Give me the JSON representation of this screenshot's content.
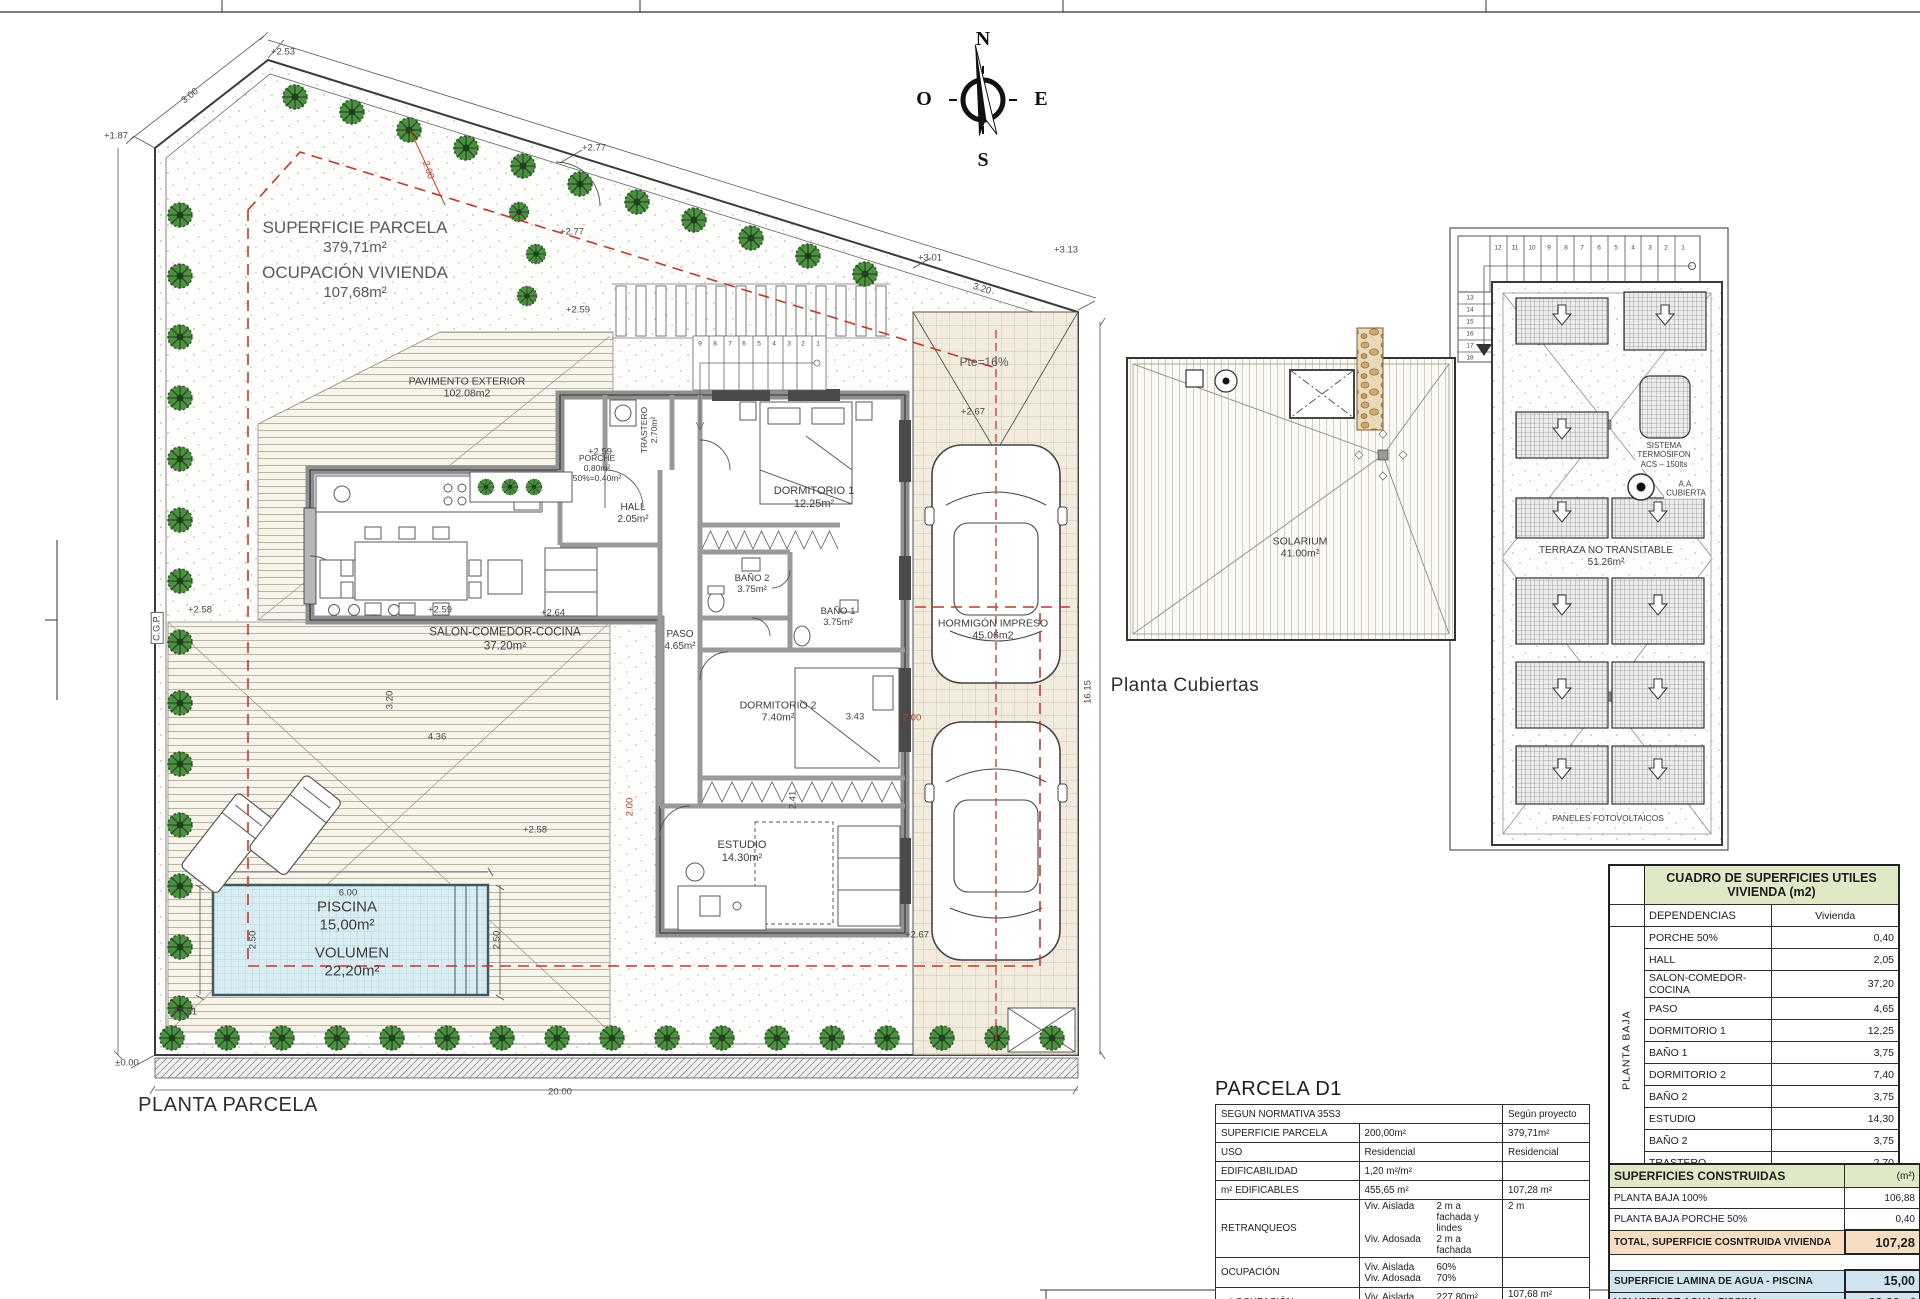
{
  "colors": {
    "accent_red": "#c0392b",
    "table_header_green": "#dfe9c5",
    "table_total_peach": "#f7ddc2",
    "table_water_blue": "#cfe4ee",
    "tree_green": "#4e8f43",
    "wall_gray": "#8f8f8f"
  },
  "icons": {
    "tree-icon": "garden tree (spiky green circle)",
    "car-icon": "top-view car",
    "lounger-icon": "sun lounger",
    "compass-rose-icon": "north arrow compass",
    "solar-panel-icon": "hatched photovoltaic panel",
    "down-arrow-icon": "white slope arrow",
    "aa-unit-icon": "air conditioning roof unit",
    "stair-icon": "stair run with numbered treads"
  },
  "plan_labels": [
    {
      "n": "parcel-surface-label",
      "lines": [
        "SUPERFICIE PARCELA"
      ],
      "x": 355,
      "y": 228,
      "s": 17,
      "cls": "g"
    },
    {
      "n": "parcel-surface-value",
      "lines": [
        "379,71m²"
      ],
      "x": 355,
      "y": 248,
      "s": 15,
      "cls": "g"
    },
    {
      "n": "parcel-occupation-label",
      "lines": [
        "OCUPACIÓN VIVIENDA"
      ],
      "x": 355,
      "y": 273,
      "s": 17,
      "cls": "g"
    },
    {
      "n": "parcel-occupation-value",
      "lines": [
        "107,68m²"
      ],
      "x": 355,
      "y": 293,
      "s": 15,
      "cls": "g"
    },
    {
      "n": "room-pavimento-exterior",
      "lines": [
        "PAVIMENTO EXTERIOR",
        "102.08m2"
      ],
      "x": 467,
      "y": 388,
      "s": 10.5
    },
    {
      "n": "room-porche",
      "lines": [
        "PORCHE",
        "0,80m²",
        "50%=0.40m²"
      ],
      "x": 597,
      "y": 468,
      "s": 8.5
    },
    {
      "n": "room-trastero",
      "lines": [
        "TRASTERO",
        "2.70m²"
      ],
      "x": 649,
      "y": 430,
      "s": 8.5,
      "r": -90
    },
    {
      "n": "room-hall",
      "lines": [
        "HALL",
        "2.05m²"
      ],
      "x": 633,
      "y": 514,
      "s": 10
    },
    {
      "n": "room-salon",
      "lines": [
        "SALON-COMEDOR-COCINA",
        "37.20m²"
      ],
      "x": 505,
      "y": 640,
      "s": 11.5
    },
    {
      "n": "room-dormitorio-1",
      "lines": [
        "DORMITORIO 1",
        "12.25m²"
      ],
      "x": 814,
      "y": 498,
      "s": 11
    },
    {
      "n": "room-bano-2",
      "lines": [
        "BAÑO 2",
        "3.75m²"
      ],
      "x": 752,
      "y": 584,
      "s": 9.5
    },
    {
      "n": "room-bano-1",
      "lines": [
        "BAÑO 1",
        "3.75m²"
      ],
      "x": 838,
      "y": 617,
      "s": 9.5
    },
    {
      "n": "room-paso",
      "lines": [
        "PASO",
        "4.65m²"
      ],
      "x": 680,
      "y": 641,
      "s": 10
    },
    {
      "n": "room-dormitorio-2",
      "lines": [
        "DORMITORIO 2",
        "7.40m²"
      ],
      "x": 778,
      "y": 712,
      "s": 10.5
    },
    {
      "n": "room-estudio",
      "lines": [
        "ESTUDIO",
        "14.30m²"
      ],
      "x": 742,
      "y": 852,
      "s": 11
    },
    {
      "n": "zone-hormigon-impreso",
      "lines": [
        "HORMIGÓN IMPRESO",
        "45.06m2"
      ],
      "x": 993,
      "y": 630,
      "s": 10.5
    },
    {
      "n": "pool-area-label",
      "lines": [
        "PISCINA",
        "15,00m²"
      ],
      "x": 347,
      "y": 916,
      "s": 15
    },
    {
      "n": "pool-volume-label",
      "lines": [
        "VOLUMEN",
        "22,20m²"
      ],
      "x": 352,
      "y": 962,
      "s": 15
    },
    {
      "n": "ramp-slope-label",
      "lines": [
        "Pte=16%"
      ],
      "x": 984,
      "y": 362,
      "s": 12,
      "cls": "g"
    },
    {
      "n": "site-plan-title",
      "lines": [
        "PLANTA PARCELA"
      ],
      "x": 228,
      "y": 1106,
      "s": 20,
      "cls": "t"
    },
    {
      "n": "roof-solarium-label",
      "lines": [
        "SOLARIUM",
        "41.00m²"
      ],
      "x": 1300,
      "y": 548,
      "s": 10.5
    },
    {
      "n": "roof-terraza-label",
      "lines": [
        "TERRAZA NO TRANSITABLE",
        "51.26m²"
      ],
      "x": 1606,
      "y": 557,
      "s": 10
    },
    {
      "n": "roof-termosifon-label",
      "lines": [
        "SISTEMA",
        "TERMOSIFON",
        "ACS – 150lts"
      ],
      "x": 1664,
      "y": 455,
      "s": 8,
      "cls": "wbg2"
    },
    {
      "n": "roof-aa-label",
      "lines": [
        "A.A.",
        "CUBIERTA"
      ],
      "x": 1686,
      "y": 489,
      "s": 8,
      "cls": "wbg2"
    },
    {
      "n": "roof-paneles-label",
      "lines": [
        "PANELES FOTOVOLTAICOS"
      ],
      "x": 1608,
      "y": 818,
      "s": 8.5
    },
    {
      "n": "roof-plan-title",
      "lines": [
        "Planta Cubiertas"
      ],
      "x": 1185,
      "y": 686,
      "s": 19,
      "cls": "t"
    },
    {
      "n": "cgp-label",
      "lines": [
        "C.G.P."
      ],
      "x": 157,
      "y": 628,
      "s": 9,
      "r": -90,
      "cls": "wbg"
    },
    {
      "n": "compass-n",
      "lines": [
        "N"
      ],
      "x": 983,
      "y": 40,
      "s": 20,
      "cls": "comp"
    },
    {
      "n": "compass-s",
      "lines": [
        "S"
      ],
      "x": 983,
      "y": 161,
      "s": 20,
      "cls": "comp"
    },
    {
      "n": "compass-o",
      "lines": [
        "O"
      ],
      "x": 924,
      "y": 100,
      "s": 20,
      "cls": "comp"
    },
    {
      "n": "compass-e",
      "lines": [
        "E"
      ],
      "x": 1041,
      "y": 100,
      "s": 20,
      "cls": "comp"
    }
  ],
  "annotations": [
    {
      "t": "+2.53",
      "x": 283,
      "y": 52
    },
    {
      "t": "3.00",
      "x": 190,
      "y": 96,
      "r": -38
    },
    {
      "t": "+1.87",
      "x": 116,
      "y": 136
    },
    {
      "t": "2.00",
      "x": 428,
      "y": 170,
      "r": 72,
      "c": "red"
    },
    {
      "t": "+2.77",
      "x": 594,
      "y": 148
    },
    {
      "t": "+2.77",
      "x": 572,
      "y": 232
    },
    {
      "t": "+2.59",
      "x": 578,
      "y": 310
    },
    {
      "t": "+3.01",
      "x": 930,
      "y": 258
    },
    {
      "t": "3.20",
      "x": 982,
      "y": 289,
      "r": 17
    },
    {
      "t": "+3.13",
      "x": 1066,
      "y": 250
    },
    {
      "t": "+2.67",
      "x": 973,
      "y": 412
    },
    {
      "t": "+2.59",
      "x": 600,
      "y": 452
    },
    {
      "t": "+2.58",
      "x": 200,
      "y": 610
    },
    {
      "t": "+2.59",
      "x": 440,
      "y": 610
    },
    {
      "t": "+2.64",
      "x": 553,
      "y": 613
    },
    {
      "t": "3.20",
      "x": 390,
      "y": 700,
      "r": -90
    },
    {
      "t": "4.36",
      "x": 437,
      "y": 737
    },
    {
      "t": "2.41",
      "x": 793,
      "y": 800,
      "r": -90
    },
    {
      "t": "2.00",
      "x": 630,
      "y": 807,
      "r": -90,
      "c": "red"
    },
    {
      "t": "3.43",
      "x": 855,
      "y": 717
    },
    {
      "t": "2.00",
      "x": 912,
      "y": 718,
      "c": "red"
    },
    {
      "t": "+2.67",
      "x": 917,
      "y": 935
    },
    {
      "t": "+2.58",
      "x": 535,
      "y": 830
    },
    {
      "t": "6.00",
      "x": 348,
      "y": 893
    },
    {
      "t": "2.50",
      "x": 253,
      "y": 940,
      "r": -90
    },
    {
      "t": "2.50",
      "x": 497,
      "y": 940,
      "r": -90
    },
    {
      "t": "+2.51",
      "x": 185,
      "y": 1012
    },
    {
      "t": "±0.00",
      "x": 127,
      "y": 1063
    },
    {
      "t": "20.00",
      "x": 560,
      "y": 1092
    },
    {
      "t": "16.15",
      "x": 1088,
      "y": 692,
      "r": -90
    },
    {
      "t": "9",
      "x": 700,
      "y": 344,
      "s": 6.5
    },
    {
      "t": "8",
      "x": 715,
      "y": 344,
      "s": 6.5
    },
    {
      "t": "7",
      "x": 730,
      "y": 344,
      "s": 6.5
    },
    {
      "t": "6",
      "x": 744,
      "y": 344,
      "s": 6.5
    },
    {
      "t": "5",
      "x": 759,
      "y": 344,
      "s": 6.5
    },
    {
      "t": "4",
      "x": 774,
      "y": 344,
      "s": 6.5
    },
    {
      "t": "3",
      "x": 789,
      "y": 344,
      "s": 6.5
    },
    {
      "t": "2",
      "x": 803,
      "y": 344,
      "s": 6.5
    },
    {
      "t": "1",
      "x": 818,
      "y": 344,
      "s": 6.5
    },
    {
      "t": "12",
      "x": 1498,
      "y": 248,
      "s": 6.5
    },
    {
      "t": "11",
      "x": 1515,
      "y": 248,
      "s": 6.5
    },
    {
      "t": "10",
      "x": 1532,
      "y": 248,
      "s": 6.5
    },
    {
      "t": "9",
      "x": 1549,
      "y": 248,
      "s": 6.5
    },
    {
      "t": "8",
      "x": 1566,
      "y": 248,
      "s": 6.5
    },
    {
      "t": "7",
      "x": 1582,
      "y": 248,
      "s": 6.5
    },
    {
      "t": "6",
      "x": 1599,
      "y": 248,
      "s": 6.5
    },
    {
      "t": "5",
      "x": 1616,
      "y": 248,
      "s": 6.5
    },
    {
      "t": "4",
      "x": 1633,
      "y": 248,
      "s": 6.5
    },
    {
      "t": "3",
      "x": 1650,
      "y": 248,
      "s": 6.5
    },
    {
      "t": "2",
      "x": 1666,
      "y": 248,
      "s": 6.5
    },
    {
      "t": "1",
      "x": 1683,
      "y": 248,
      "s": 6.5
    },
    {
      "t": "13",
      "x": 1470,
      "y": 298,
      "s": 6.5
    },
    {
      "t": "14",
      "x": 1470,
      "y": 310,
      "s": 6.5
    },
    {
      "t": "15",
      "x": 1470,
      "y": 322,
      "s": 6.5
    },
    {
      "t": "16",
      "x": 1470,
      "y": 334,
      "s": 6.5
    },
    {
      "t": "17",
      "x": 1470,
      "y": 346,
      "s": 6.5
    },
    {
      "t": "18",
      "x": 1470,
      "y": 358,
      "s": 6.5
    }
  ],
  "useful_table": {
    "title_line1": "CUADRO DE SUPERFICIES UTILES",
    "title_line2": "VIVIENDA (m2)",
    "col_dep": "DEPENDENCIAS",
    "col_viv": "Vivienda",
    "side_label": "PLANTA BAJA",
    "rows": [
      {
        "label": "PORCHE 50%",
        "value": "0,40"
      },
      {
        "label": "HALL",
        "value": "2,05"
      },
      {
        "label": "SALON-COMEDOR-COCINA",
        "value": "37,20"
      },
      {
        "label": "PASO",
        "value": "4,65"
      },
      {
        "label": "DORMITORIO 1",
        "value": "12,25"
      },
      {
        "label": "BAÑO 1",
        "value": "3,75"
      },
      {
        "label": "DORMITORIO 2",
        "value": "7,40"
      },
      {
        "label": "BAÑO 2",
        "value": "3,75"
      },
      {
        "label": "ESTUDIO",
        "value": "14,30"
      },
      {
        "label": "BAÑO 2",
        "value": "3,75"
      },
      {
        "label": "TRASTERO",
        "value": "2,70"
      }
    ],
    "total_label": "TOTAL SUP. UTIL VIV.",
    "total_value": "92,20"
  },
  "built_table": {
    "header": "SUPERFICIES CONSTRUIDAS",
    "header_unit": "(m²)",
    "rows": [
      {
        "label": "PLANTA BAJA 100%",
        "value": "106,88"
      },
      {
        "label": "PLANTA BAJA PORCHE 50%",
        "value": "0,40"
      }
    ],
    "total_label": "TOTAL, SUPERFICIE COSNTRUIDA VIVIENDA",
    "total_value": "107,28",
    "water_rows": [
      {
        "label": "SUPERFICIE LAMINA DE AGUA - PISCINA",
        "value": "15,00"
      },
      {
        "label": "VOLUMEN DE AGUA, PISCINA",
        "value": "22,20m³"
      }
    ]
  },
  "parcela_table": {
    "title": "PARCELA D1",
    "header_left": "SEGUN NORMATIVA 35S3",
    "header_right": "Según proyecto",
    "rows": [
      {
        "label": "SUPERFICIE PARCELA",
        "norm": "200,00m²",
        "proj": "379,71m²"
      },
      {
        "label": "USO",
        "norm": "Residencial",
        "proj": "Residencial"
      },
      {
        "label": "EDIFICABILIDAD",
        "norm": "1,20 m²/m²",
        "proj": ""
      },
      {
        "label": "m² EDIFICABLES",
        "norm": "455,65 m²",
        "proj": "107,28 m²"
      }
    ],
    "multi_rows": [
      {
        "label": "RETRANQUEOS",
        "lines": [
          {
            "k": "Viv. Aislada",
            "v": "2 m a fachada y lindes"
          },
          {
            "k": "Viv. Adosada",
            "v": "2 m a fachada"
          }
        ],
        "proj": "2 m"
      },
      {
        "label": "OCUPACIÓN",
        "lines": [
          {
            "k": "Viv. Aislada",
            "v": "60%"
          },
          {
            "k": "Viv. Adosada",
            "v": "70%"
          }
        ],
        "proj": ""
      },
      {
        "label": "m² OCUPACIÓN",
        "lines": [
          {
            "k": "Viv. Aislada",
            "v": "227,80m²"
          },
          {
            "k": "Viv. Adosada",
            "v": "265,80m²"
          }
        ],
        "proj": "107,68 m²"
      }
    ]
  }
}
